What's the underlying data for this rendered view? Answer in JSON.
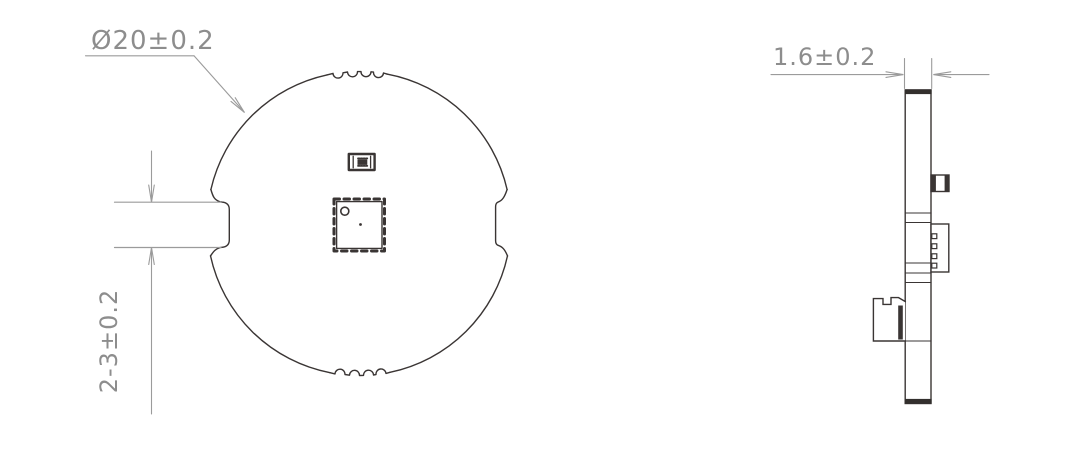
{
  "front_view": {
    "name": "pcb-front-view",
    "dim_diameter": "Ø20±0.2",
    "dim_cable_width": "2-3±0.2"
  },
  "side_view": {
    "name": "pcb-side-view",
    "dim_thickness": "1.6±0.2"
  },
  "colors": {
    "outline": "#3a3534",
    "dimension_line": "#9b9b9b",
    "dimension_text": "#8d8d8d",
    "background": "#ffffff"
  }
}
